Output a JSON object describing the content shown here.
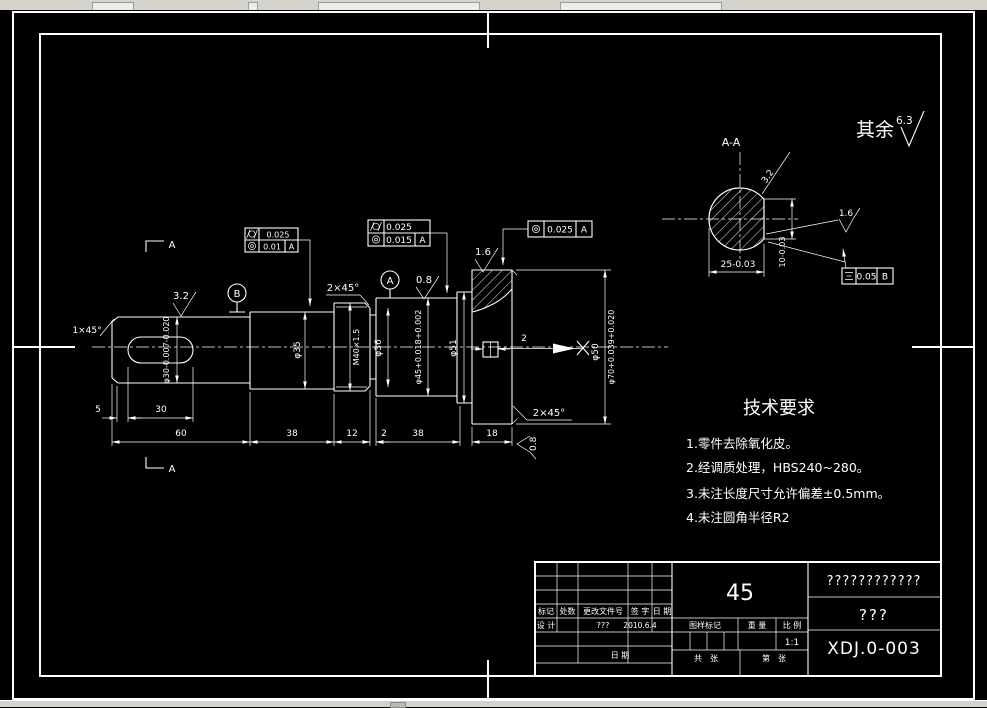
{
  "drawing": {
    "surface_default": {
      "label": "其余",
      "value": "6.3"
    },
    "section_view": {
      "title": "A-A",
      "dim_width": "25-0.03",
      "dim_depth": "10-0.03",
      "roughness_slant": "3.2",
      "roughness_flat": "1.6",
      "symmetry": {
        "icon": "symmetry-icon",
        "value": "0.05",
        "datum": "B"
      }
    },
    "labels": {
      "section_arrow_top": "A",
      "section_arrow_bottom": "A"
    },
    "chamfers": {
      "left": "1×45°",
      "thread": "2×45°",
      "flange": "2×45°"
    },
    "roughness": {
      "key_section": "3.2",
      "mid_section": "0.8",
      "flange_top": "1.6",
      "flange_side": "0.8"
    },
    "datums": {
      "a": "A",
      "b": "B"
    },
    "frames": {
      "f1": {
        "row1_icon": "cylindricity-icon",
        "row1_value": "0.025",
        "row2_icon": "concentricity-icon",
        "row2_value": "0.01",
        "row2_datum": "A"
      },
      "f2": {
        "row1_icon": "cylindricity-icon",
        "row1_value": "0.025",
        "row2_icon": "concentricity-icon",
        "row2_value": "0.015",
        "row2_datum": "A"
      },
      "f3": {
        "icon": "concentricity-icon",
        "value": "0.025",
        "datum": "A"
      }
    },
    "diameters": {
      "phi30": "φ30-0.007-0.020",
      "phi35": "φ35",
      "thread": "M40×1.5",
      "phi36": "φ36",
      "phi45": "φ45+0.018+0.002",
      "phi51": "φ51",
      "phi50": "φ50",
      "phi70": "φ70+0.039+0.020"
    },
    "pin_width": "2",
    "lengths": {
      "l1": "5",
      "l2": "30",
      "l3": "60",
      "l4": "38",
      "l5": "12",
      "l6": "2",
      "l7": "38",
      "l8": "18"
    }
  },
  "tech": {
    "title": "技术要求",
    "items": [
      "1.零件去除氧化皮。",
      "2.经调质处理，HBS240~280。",
      "3.未注长度尺寸允许偏差±0.5mm。",
      "4.未注圆角半径R2"
    ]
  },
  "title_block": {
    "material": "45",
    "name_unresolved": "????????????",
    "code_unresolved": "???",
    "drawing_no": "XDJ.0-003",
    "rev_headers": {
      "mark": "标记",
      "count": "处数",
      "file": "更改文件号",
      "sign": "签 字",
      "date": "日 期"
    },
    "design_label": "设 计",
    "designer": "???",
    "design_date": "2010.6.4",
    "date_label": "日 期",
    "stamp_label": "图样标记",
    "weight_label": "重 量",
    "scale_label": "比 例",
    "scale_value": "1:1",
    "sheets_total": "共　张",
    "sheet_no": "第　张"
  }
}
